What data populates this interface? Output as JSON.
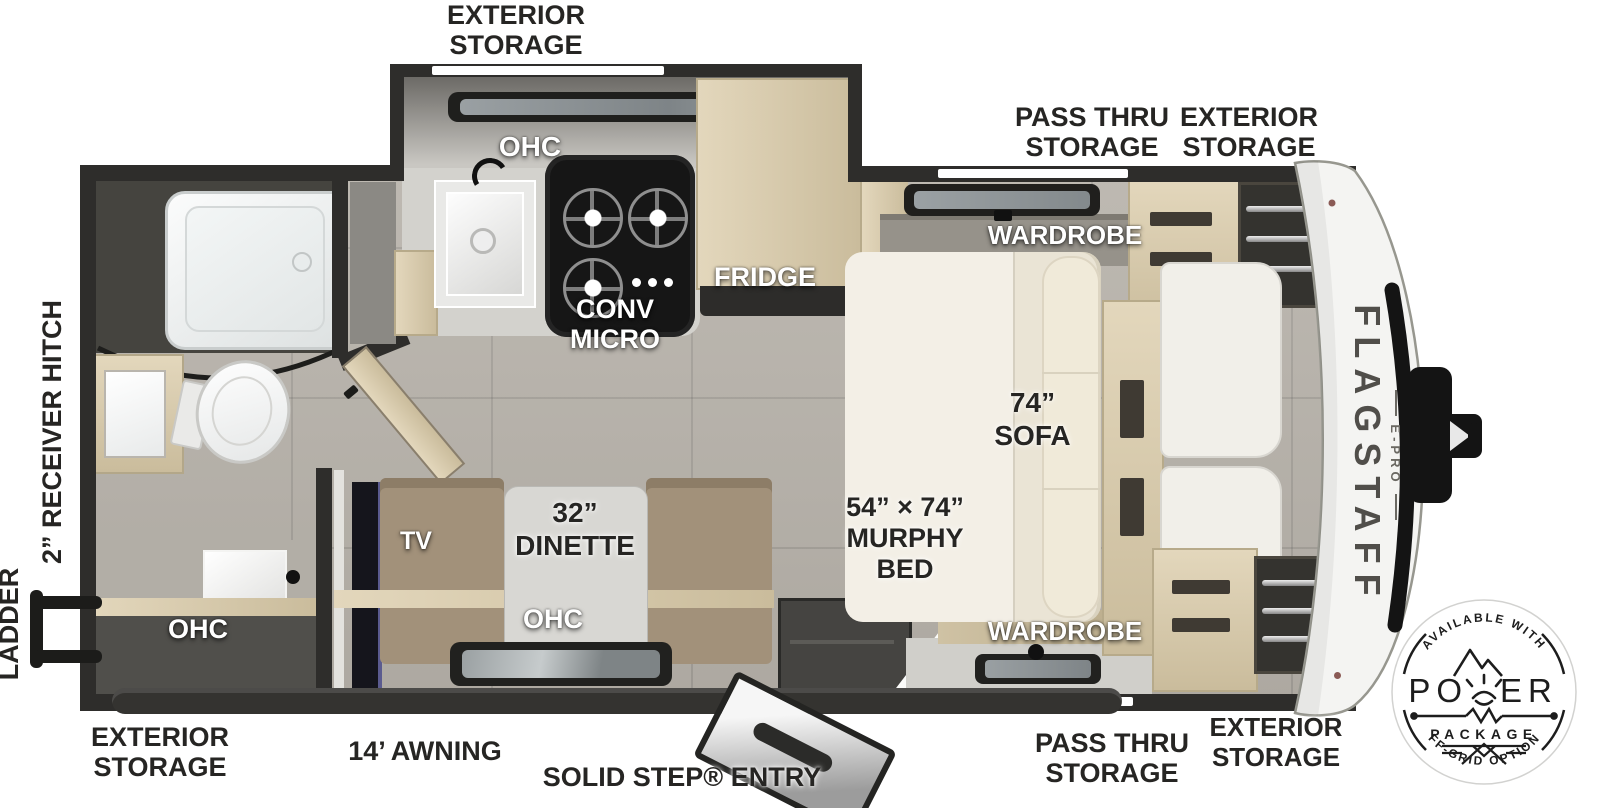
{
  "canvas": {
    "width": 1600,
    "height": 808
  },
  "brand": {
    "name": "FLAGSTAFF",
    "series": "E-PRO"
  },
  "exterior_labels": {
    "top_storage": [
      "EXTERIOR",
      "STORAGE"
    ],
    "top_pass_thru": [
      "PASS THRU",
      "STORAGE"
    ],
    "top_right_storage": [
      "EXTERIOR",
      "STORAGE"
    ],
    "receiver_hitch": "2” RECEIVER HITCH",
    "ladder": "LADDER",
    "bottom_left_storage": [
      "EXTERIOR",
      "STORAGE"
    ],
    "awning": "14’ AWNING",
    "entry": "SOLID STEP® ENTRY",
    "bottom_pass_thru": [
      "PASS THRU",
      "STORAGE"
    ],
    "bottom_right_storage": [
      "EXTERIOR",
      "STORAGE"
    ]
  },
  "interior_labels": {
    "kitchen_ohc": "OHC",
    "conv_micro": [
      "CONV",
      "MICRO"
    ],
    "fridge": "FRIDGE",
    "wardrobe_top": "WARDROBE",
    "wardrobe_bottom": "WARDROBE",
    "sofa": [
      "74”",
      "SOFA"
    ],
    "murphy_bed": [
      "54” × 74”",
      "MURPHY",
      "BED"
    ],
    "dinette": [
      "32”",
      "DINETTE"
    ],
    "dinette_ohc": "OHC",
    "bath_ohc": "OHC",
    "tv": "TV"
  },
  "badge": {
    "arc_top": "AVAILABLE WITH",
    "power_left": "PO",
    "power_right": "ER",
    "package": "PACKAGE",
    "arc_bottom": "OFF-GRID OPTIONS"
  },
  "colors": {
    "wall": "#2e2d2b",
    "floor": "#b8b3ab",
    "wood": "#d7caae",
    "counter": "#d3d2cd",
    "sofa": "#eae4d5",
    "bench": "#a2917a",
    "stove": "#161616",
    "label_dark": "#262523",
    "label_light": "#ffffff",
    "tv_accent": "#5b5b8f"
  }
}
